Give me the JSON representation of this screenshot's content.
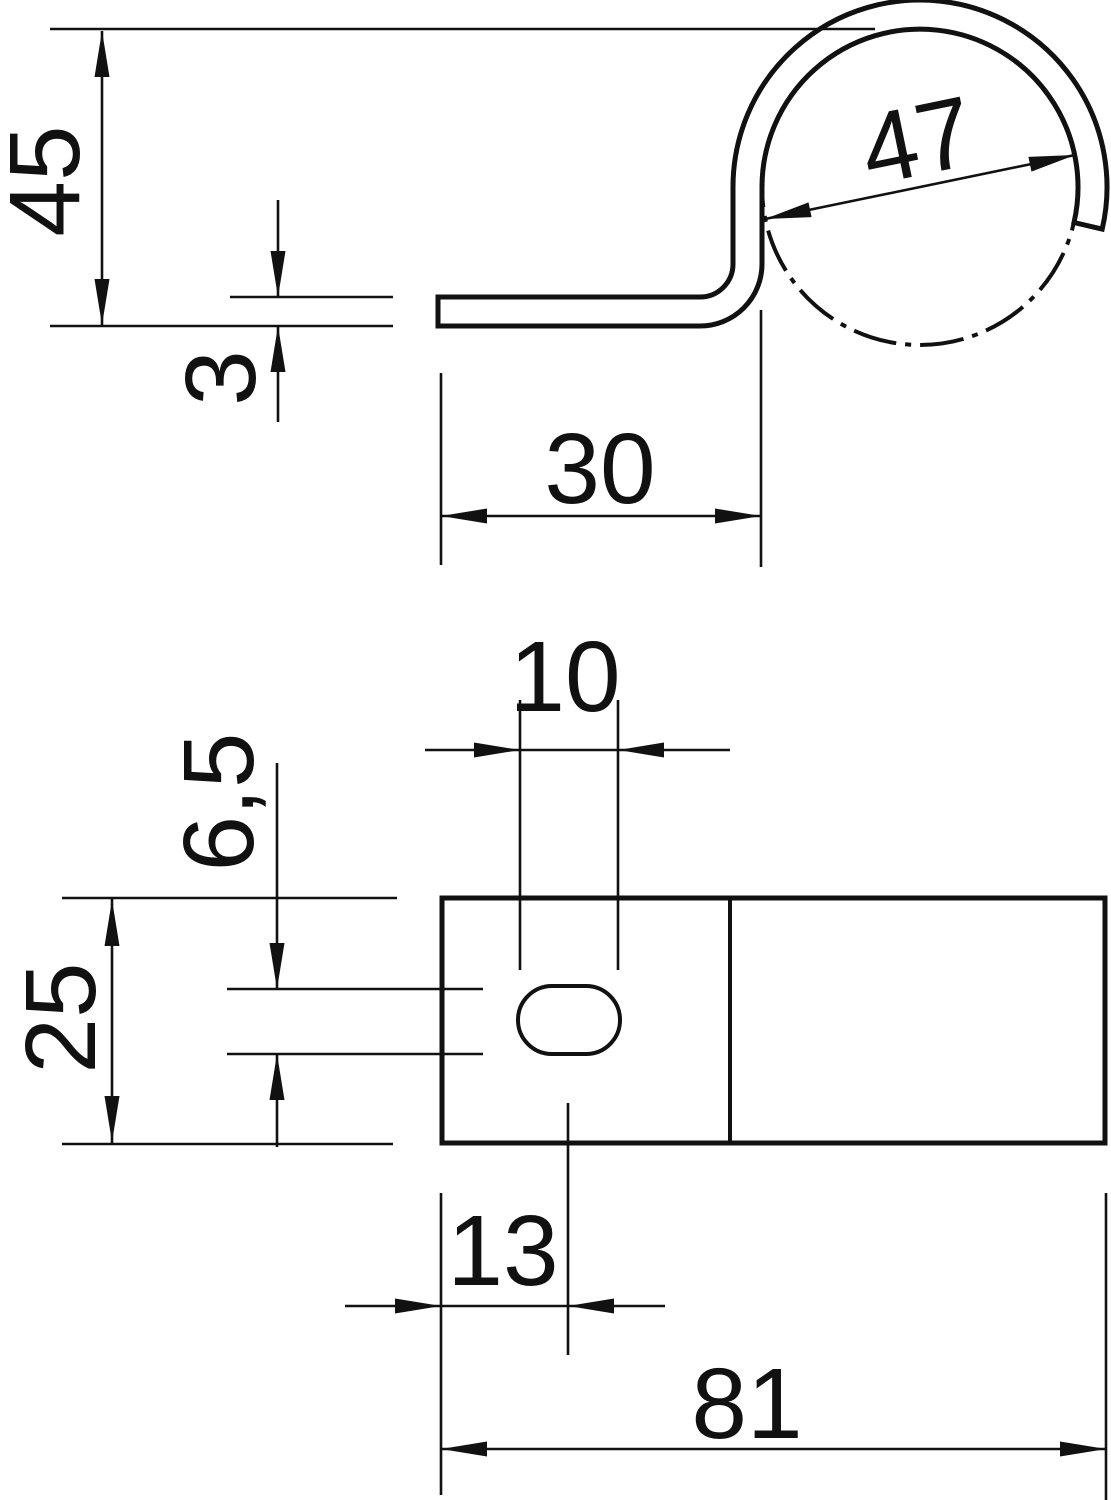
{
  "drawing": {
    "background_color": "#ffffff",
    "line_color": "#111111",
    "views": {
      "side_view": {
        "dimensions": {
          "d45": {
            "label": "45"
          },
          "d3": {
            "label": "3"
          },
          "d30": {
            "label": "30"
          },
          "d47": {
            "label": "47"
          }
        }
      },
      "plan_view": {
        "dimensions": {
          "d10": {
            "label": "10"
          },
          "d65": {
            "label": "6,5"
          },
          "d25": {
            "label": "25"
          },
          "d13": {
            "label": "13"
          },
          "d81": {
            "label": "81"
          }
        }
      }
    }
  }
}
